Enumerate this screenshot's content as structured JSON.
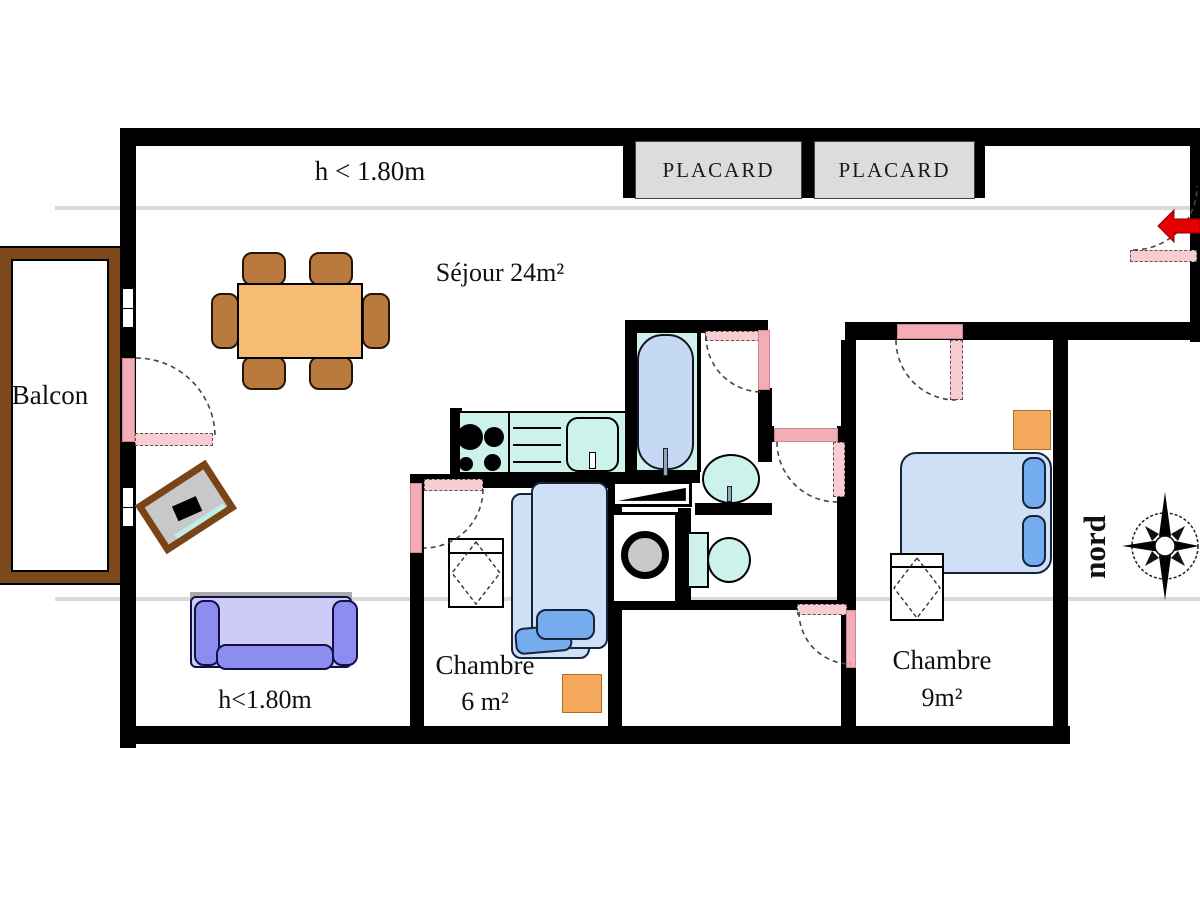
{
  "labels": {
    "height_note_top": "h < 1.80m",
    "living_room": "Séjour 24m²",
    "balcony": "Balcon",
    "closet_left": "PLACARD",
    "closet_right": "PLACARD",
    "bedroom_small_name": "Chambre",
    "bedroom_small_area": "6 m²",
    "bedroom_large_name": "Chambre",
    "bedroom_large_area": "9m²",
    "height_note_bottom": "h<1.80m",
    "compass": "nord"
  },
  "colors": {
    "wall": "#000000",
    "door_pink": "#f2aeb4",
    "balcony_wood": "#7c4a1a",
    "table_orange": "#f6bc72",
    "chair_brown": "#ba7a3e",
    "sofa_light": "#ccccf6",
    "sofa_dark": "#8d8df0",
    "bed_blue": "#cfe0f6",
    "pillow_blue": "#74acee",
    "fixture_cyan": "#cdf2ec",
    "tub_blue": "#c6d9f4",
    "accent_orange": "#f4a85c",
    "entry_arrow_red": "#e60000",
    "guide_gray": "#d9d9d9",
    "closet_gray": "#dcdcdc"
  }
}
